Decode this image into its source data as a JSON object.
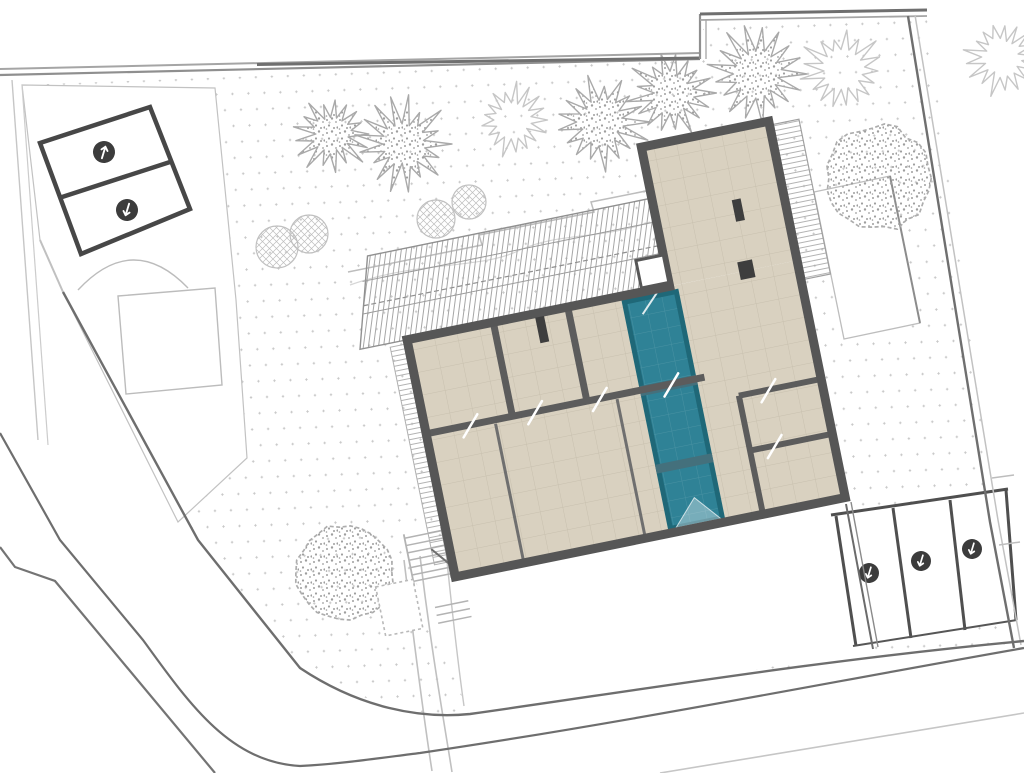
{
  "document": {
    "title": "Architectural site plan — ground floor with pool",
    "type": "site-plan",
    "background": "#ffffff"
  },
  "colors": {
    "pool": "#2f8296",
    "pool_border": "#1f6878",
    "pool_divider": "#44707c",
    "pool_grid": "rgba(255,255,255,0.12)",
    "floor": "#d9d1c0",
    "floor_grid": "#c8c0ae",
    "wall": "#565656",
    "wall_interior": "#5c5c5c",
    "roof_hatch": "#a6a6a6",
    "ground_dot": "#c9c9c9",
    "site_light": "#c0c0c0",
    "site_medium": "#8f8f8f",
    "site_dark": "#6e6e6e",
    "parking_outline": "#474747",
    "marker_fill": "#3c3c3c",
    "marker_glyph": "#ffffff",
    "tree_stipple": "#9e9e9e",
    "tree_stroke": "#a9a9a9",
    "tree_outline": "#c6c6c6",
    "shrub_stroke": "#c0c0c0"
  },
  "building": {
    "rotation_deg": -11.5,
    "wings": {
      "main": "lower wing with room grid and pool strip",
      "tall": "upper wing / roof terrace"
    },
    "pool_segments": 3,
    "skylight_count": 1,
    "chimney_count": 3,
    "door_marks": 6
  },
  "site": {
    "parking_upper": {
      "stall_count": 2,
      "markers": [
        {
          "x": 104,
          "y": 152,
          "r": 11,
          "angle": -30
        },
        {
          "x": 127,
          "y": 210,
          "r": 11,
          "angle": 150
        }
      ]
    },
    "parking_lower": {
      "stall_count": 3,
      "markers": [
        {
          "x": 869,
          "y": 573,
          "r": 10,
          "angle": 150
        },
        {
          "x": 921,
          "y": 561,
          "r": 10,
          "angle": 150
        },
        {
          "x": 972,
          "y": 549,
          "r": 10,
          "angle": 150
        }
      ]
    },
    "trees_spiky": [
      {
        "x": 332,
        "y": 134,
        "r": 40,
        "variant": "stippled"
      },
      {
        "x": 404,
        "y": 144,
        "r": 47,
        "variant": "stippled"
      },
      {
        "x": 513,
        "y": 120,
        "r": 38,
        "variant": "outline"
      },
      {
        "x": 601,
        "y": 122,
        "r": 47,
        "variant": "stippled"
      },
      {
        "x": 672,
        "y": 93,
        "r": 44,
        "variant": "stippled"
      },
      {
        "x": 758,
        "y": 74,
        "r": 50,
        "variant": "stippled"
      },
      {
        "x": 843,
        "y": 71,
        "r": 44,
        "variant": "outline"
      },
      {
        "x": 1002,
        "y": 57,
        "r": 40,
        "variant": "outline"
      }
    ],
    "trees_round": [
      {
        "x": 345,
        "y": 572,
        "r": 50
      },
      {
        "x": 878,
        "y": 178,
        "r": 54
      }
    ],
    "shrubs_crosshatch": [
      {
        "x": 277,
        "y": 247,
        "r": 21
      },
      {
        "x": 309,
        "y": 234,
        "r": 19
      },
      {
        "x": 436,
        "y": 219,
        "r": 19
      },
      {
        "x": 469,
        "y": 202,
        "r": 17
      }
    ]
  }
}
